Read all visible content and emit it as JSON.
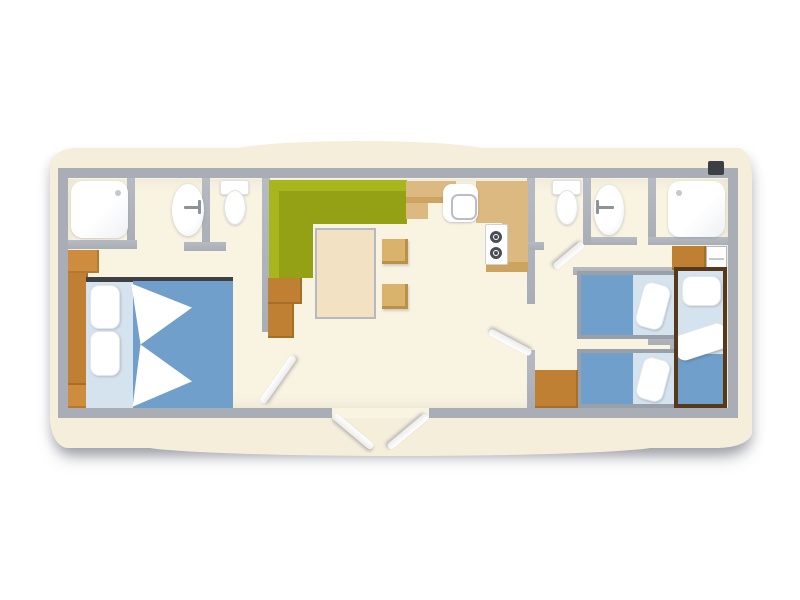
{
  "meta": {
    "type": "floor-plan",
    "subject": "mobile-home top-view layout, no text labels",
    "style": "flat color plan on crumpled cream paper"
  },
  "palette": {
    "paper": "#f5eedb",
    "floor": "#f9f3e2",
    "wall": "#a9aeb6",
    "wall_hi": "#b6bbc3",
    "sofa_green": "#a9b51d",
    "sofa_green_dark": "#95a114",
    "wood_orange": "#bf8034",
    "wood_orange_light": "#cd8c3e",
    "counter_tan": "#dcb980",
    "counter_tan_dark": "#cda360",
    "table_cream": "#f2e2c3",
    "stool_tan": "#d9b26b",
    "bed_blue": "#6f9fca",
    "bed_blue_light": "#d5e3ef",
    "bed_frame_gray": "#99a0aa",
    "bed_frame_brown": "#56391a",
    "burner_dark": "#4a4f57"
  },
  "rooms": [
    {
      "id": "bathroom-left",
      "items": [
        "shower",
        "washbasin",
        "toilet"
      ]
    },
    {
      "id": "master-bedroom",
      "items": [
        "double-bed",
        "pillow",
        "pillow",
        "wardrobe"
      ]
    },
    {
      "id": "living-area",
      "items": [
        "corner-sofa",
        "coffee-table",
        "stool",
        "stool",
        "storage-cabinet"
      ]
    },
    {
      "id": "kitchen",
      "items": [
        "sink-unit",
        "hob-two-burners",
        "worktop",
        "cabinets"
      ]
    },
    {
      "id": "bathroom-right",
      "items": [
        "toilet",
        "washbasin",
        "shower"
      ]
    },
    {
      "id": "kids-bedrooms",
      "items": [
        "single-bed",
        "single-bed",
        "single-bed-vertical",
        "cabinet",
        "shelf",
        "corridor-cabinet"
      ]
    },
    {
      "id": "entry",
      "items": [
        "double-door-outswing"
      ]
    }
  ],
  "doors": [
    "master-bedroom-door",
    "hallway-door",
    "right-bathroom-door",
    "entry-door-left-leaf",
    "entry-door-right-leaf"
  ]
}
